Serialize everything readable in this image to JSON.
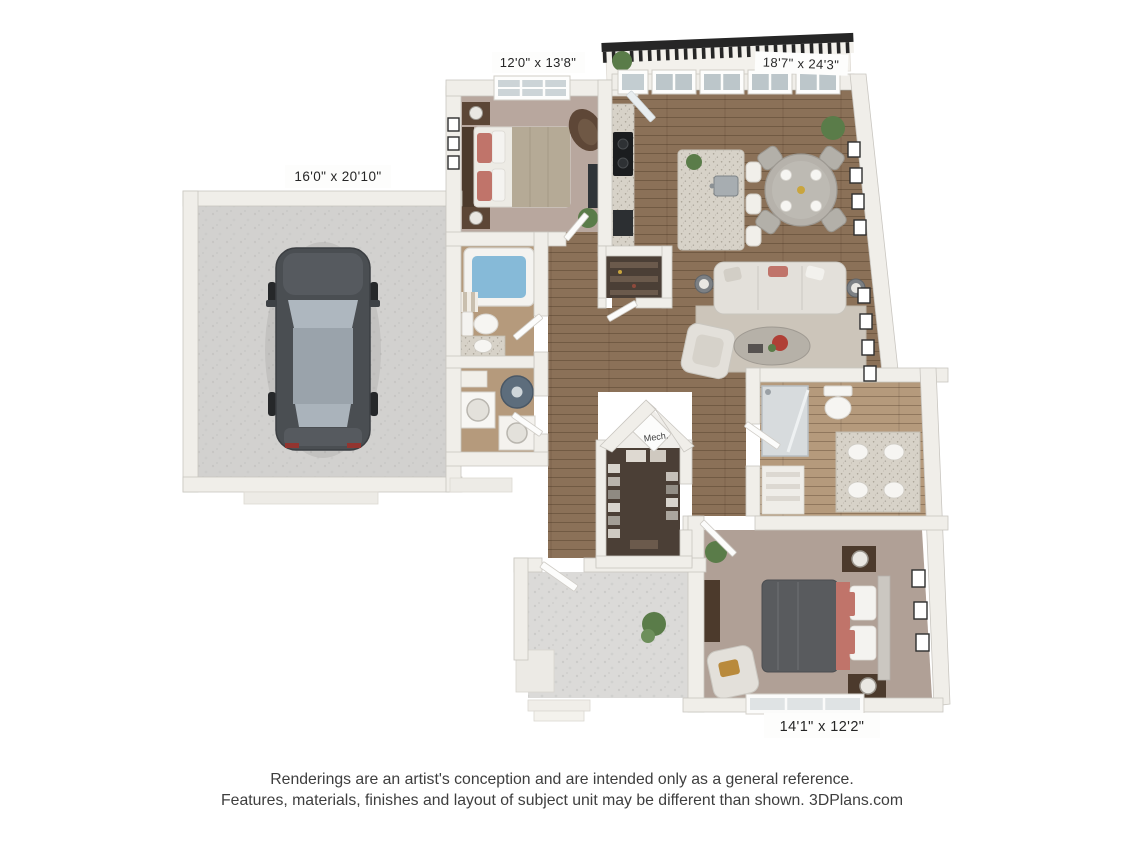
{
  "floorplan": {
    "type": "3d-floor-plan-rendering",
    "rooms": [
      {
        "id": "garage",
        "dimensions": "16'0\" x 20'10\""
      },
      {
        "id": "bedroom-2",
        "dimensions": "12'0\" x 13'8\""
      },
      {
        "id": "living-dining-kitchen",
        "dimensions": "18'7\" x 24'3\""
      },
      {
        "id": "master-bedroom",
        "dimensions": "14'1\" x 12'2\""
      },
      {
        "id": "mechanical-closet",
        "label": "Mech."
      }
    ],
    "colors": {
      "wall": "#f0eee9",
      "wall_outline": "#c9c6c0",
      "wood_floor": "#8b7158",
      "bath_floor": "#b59a7c",
      "carpet_bedroom2": "#b8a79e",
      "carpet_master": "#b0a096",
      "closet_floor": "#4b3f36",
      "garage_concrete": "#d2d1cf",
      "patio_concrete": "#dbdad8",
      "tub_water": "#86bad8",
      "coral_accent": "#c0746a",
      "master_comforter": "#595b5e",
      "granite": "#d7d2c8",
      "sofa": "#e3e0da",
      "car_body": "#4a4e52",
      "plant_green": "#5a7c49",
      "railing_dark": "#262626",
      "label_text": "#262626",
      "disclaimer_text": "#3e3e3e"
    }
  },
  "disclaimer": {
    "line1": "Renderings are an artist's conception and are intended only as a general reference.",
    "line2": "Features, materials, finishes and layout of subject unit may be different than shown. 3DPlans.com"
  }
}
